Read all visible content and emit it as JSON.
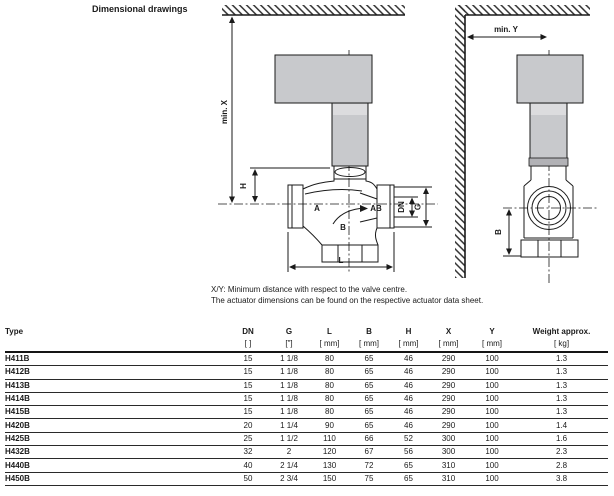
{
  "page": {
    "section_title": "Dimensional drawings"
  },
  "drawing_front": {
    "labels": {
      "min_x": "min. X",
      "h": "H",
      "l": "L",
      "a_port": "A",
      "ab_port": "AB",
      "b_port": "B",
      "dn": "DN",
      "g": "G"
    }
  },
  "drawing_side": {
    "labels": {
      "min_y": "min. Y",
      "b": "B"
    }
  },
  "notes": {
    "line1": "X/Y: Minimum distance with respect to the valve centre.",
    "line2": "The actuator dimensions can be found on the respective actuator data sheet."
  },
  "colors": {
    "actuator_gray": "#c8c9cc",
    "actuator_light": "#dcdcde",
    "line": "#1a1a1a"
  },
  "table": {
    "columns": [
      {
        "label": "Type",
        "unit": ""
      },
      {
        "label": "DN",
        "unit": "[ ]"
      },
      {
        "label": "G",
        "unit": "[\"]"
      },
      {
        "label": "L",
        "unit": "[ mm]"
      },
      {
        "label": "B",
        "unit": "[ mm]"
      },
      {
        "label": "H",
        "unit": "[ mm]"
      },
      {
        "label": "X",
        "unit": "[ mm]"
      },
      {
        "label": "Y",
        "unit": "[ mm]"
      },
      {
        "label": "Weight approx.",
        "unit": "[ kg]"
      }
    ],
    "rows": [
      {
        "type": "H411B",
        "values": [
          "15",
          "1 1/8",
          "80",
          "65",
          "46",
          "290",
          "100",
          "1.3"
        ]
      },
      {
        "type": "H412B",
        "values": [
          "15",
          "1 1/8",
          "80",
          "65",
          "46",
          "290",
          "100",
          "1.3"
        ]
      },
      {
        "type": "H413B",
        "values": [
          "15",
          "1 1/8",
          "80",
          "65",
          "46",
          "290",
          "100",
          "1.3"
        ]
      },
      {
        "type": "H414B",
        "values": [
          "15",
          "1 1/8",
          "80",
          "65",
          "46",
          "290",
          "100",
          "1.3"
        ]
      },
      {
        "type": "H415B",
        "values": [
          "15",
          "1 1/8",
          "80",
          "65",
          "46",
          "290",
          "100",
          "1.3"
        ]
      },
      {
        "type": "H420B",
        "values": [
          "20",
          "1 1/4",
          "90",
          "65",
          "46",
          "290",
          "100",
          "1.4"
        ]
      },
      {
        "type": "H425B",
        "values": [
          "25",
          "1 1/2",
          "110",
          "66",
          "52",
          "300",
          "100",
          "1.6"
        ]
      },
      {
        "type": "H432B",
        "values": [
          "32",
          "2",
          "120",
          "67",
          "56",
          "300",
          "100",
          "2.3"
        ]
      },
      {
        "type": "H440B",
        "values": [
          "40",
          "2 1/4",
          "130",
          "72",
          "65",
          "310",
          "100",
          "2.8"
        ]
      },
      {
        "type": "H450B",
        "values": [
          "50",
          "2 3/4",
          "150",
          "75",
          "65",
          "310",
          "100",
          "3.8"
        ]
      }
    ]
  }
}
